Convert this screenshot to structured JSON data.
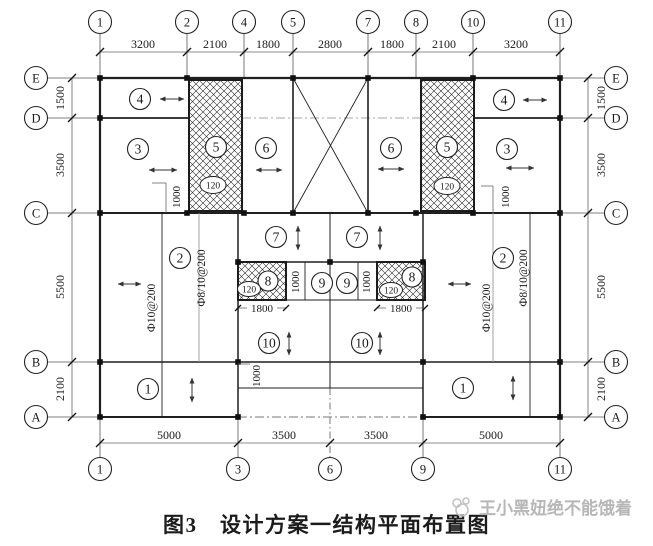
{
  "caption": "图3　设计方案一结构平面布置图",
  "watermark": "王小黑妞绝不能饿着",
  "axes": {
    "top_labels": [
      "1",
      "2",
      "4",
      "5",
      "7",
      "8",
      "10",
      "11"
    ],
    "top_dims": [
      "3200",
      "2100",
      "1800",
      "2800",
      "1800",
      "2100",
      "3200"
    ],
    "bottom_labels": [
      "1",
      "3",
      "6",
      "9",
      "11"
    ],
    "bottom_dims": [
      "5000",
      "3500",
      "3500",
      "5000"
    ],
    "left_labels": [
      "E",
      "D",
      "C",
      "B",
      "A"
    ],
    "left_dims": [
      "1500",
      "3500",
      "5500",
      "2100"
    ],
    "right_labels": [
      "E",
      "D",
      "C",
      "B",
      "A"
    ],
    "right_dims": [
      "1500",
      "3500",
      "5500",
      "2100"
    ]
  },
  "panels": {
    "p1": "1",
    "p2": "2",
    "p3": "3",
    "p4": "4",
    "p5": "5",
    "p6": "6",
    "p7": "7",
    "p8": "8",
    "p9": "9",
    "p10": "10"
  },
  "annotations": {
    "slab_thickness": "120",
    "dim_1000": "1000",
    "dim_1800": "1800",
    "rebar_phi10": "Ф10@200",
    "rebar_phi8_10": "Ф8/10@200"
  }
}
